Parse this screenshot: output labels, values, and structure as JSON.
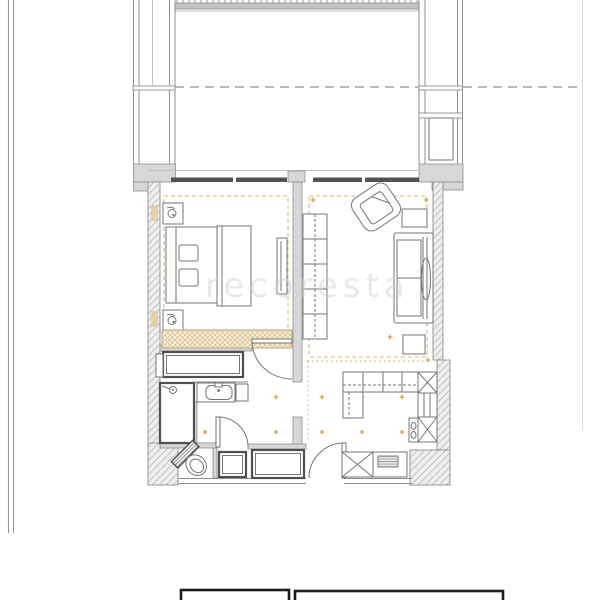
{
  "document": {
    "kind": "apartment floor plan drawing",
    "watermark": "recoresta"
  },
  "colors": {
    "background": "#ffffff",
    "wall_line": "#8f8f8f",
    "wall_dark": "#4f4f4f",
    "wall_fill": "#d7d7d7",
    "window_frame": "#535353",
    "accent_tan": "#cfa255",
    "accent_diamond": "#d9a85f",
    "furniture_line": "#767676",
    "titleblock_line": "#1c1c1c",
    "border_line": "#9a9a9a",
    "railing_fill": "#c4c4c4",
    "watermark_color": "#cfcfcf"
  },
  "icons": {
    "bed-icon": "rect with pillows",
    "lamp-icon": "small circle on nightstand",
    "sofa-icon": "rect with back cushions",
    "armchair-icon": "rotated rounded rect",
    "shower-icon": "thick rect with sprayer",
    "sink-icon": "rounded basin with faucet dot",
    "toilet-icon": "rotated bowl with cistern",
    "spotlight-icon": "tan four-point diamond",
    "door-swing-icon": "quarter-circle arc",
    "wardrobe-icon": "tan cross-hatched band",
    "stair-tick-icon": "tick marks above balcony railing"
  }
}
